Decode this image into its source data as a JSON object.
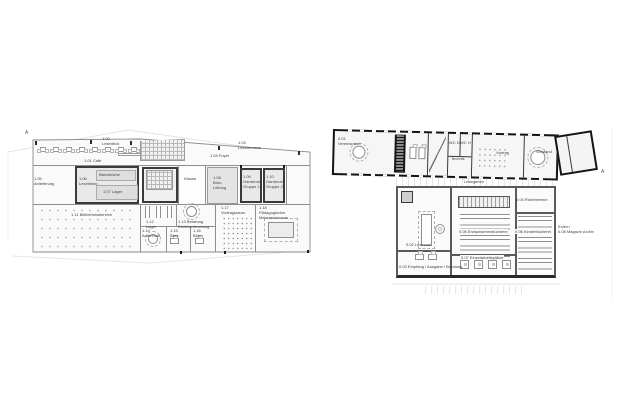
{
  "canvas": {
    "width": 625,
    "height": 400,
    "background": "#ffffff"
  },
  "drawing_type": "architectural floor plans, two levels side by side, grayscale",
  "colors": {
    "wall_dark": "#141414",
    "wall_mid": "#5a5a5a",
    "wall_light": "#8f8f8f",
    "room_gray": "#e4e4e4",
    "fill_light": "#f7f7f7",
    "label_text": "#3f3f3f",
    "site_line": "#e2e2e2"
  },
  "plans": {
    "left": {
      "name": "upper-floor-plan",
      "labels": [
        {
          "text": "A",
          "x": 25,
          "y": 130,
          "marker": true
        },
        {
          "text": "1.01 Café",
          "x": 84,
          "y": 158
        },
        {
          "text": "1.02\nLesedeck",
          "x": 102,
          "y": 136
        },
        {
          "text": "1.03\nLeseterrasse",
          "x": 238,
          "y": 140
        },
        {
          "text": "1.04 Foyer",
          "x": 210,
          "y": 153
        },
        {
          "text": "1.05\nAnlieferung",
          "x": 34,
          "y": 176
        },
        {
          "text": "1.06\nLesebistro",
          "x": 79,
          "y": 176
        },
        {
          "text": "Bistroküche",
          "x": 99,
          "y": 172
        },
        {
          "text": "1.07 Lager",
          "x": 103,
          "y": 189
        },
        {
          "text": "Klause",
          "x": 184,
          "y": 176
        },
        {
          "text": "1.08\nBüro\nLeitung",
          "x": 213,
          "y": 175
        },
        {
          "text": "1.09\nGarderobe\nGruppe 1",
          "x": 243,
          "y": 174
        },
        {
          "text": "1.10\nGarderobe\nGruppe 2",
          "x": 266,
          "y": 174
        },
        {
          "text": "1.11 Bibliotheksbereich",
          "x": 70,
          "y": 212,
          "bg": true
        },
        {
          "text": "1.12\nLager",
          "x": 146,
          "y": 219
        },
        {
          "text": "1.13 Beratung\nDirektverbuchung",
          "x": 178,
          "y": 219
        },
        {
          "text": "1.14\nAufenthalt",
          "x": 142,
          "y": 228
        },
        {
          "text": "1.15\nBüro",
          "x": 170,
          "y": 228
        },
        {
          "text": "1.16\nBüro",
          "x": 193,
          "y": 228
        },
        {
          "text": "1.17\nVortragsraum",
          "x": 221,
          "y": 205
        },
        {
          "text": "1.18\nPädagogischer\nMehrzweckraum",
          "x": 259,
          "y": 205
        }
      ]
    },
    "right": {
      "name": "ground-floor-plan",
      "labels": [
        {
          "text": "0.01\nVereinsraum",
          "x": 338,
          "y": 136
        },
        {
          "text": "WC D",
          "x": 449,
          "y": 140
        },
        {
          "text": "WC H",
          "x": 460,
          "y": 140
        },
        {
          "text": "Technik",
          "x": 451,
          "y": 156
        },
        {
          "text": "Vortrag",
          "x": 496,
          "y": 150
        },
        {
          "text": "Vorstand",
          "x": 536,
          "y": 149
        },
        {
          "text": "Lesegarten",
          "x": 464,
          "y": 179
        },
        {
          "text": "0.02 Lesesaal",
          "x": 406,
          "y": 242
        },
        {
          "text": "0.03 Empfang / Ausgabe / Beratung",
          "x": 399,
          "y": 264
        },
        {
          "text": "0.04 Ruhebereich",
          "x": 516,
          "y": 197
        },
        {
          "text": "0.05 Erwachsenenbücherei",
          "x": 458,
          "y": 229,
          "bg": true
        },
        {
          "text": "0.06 Kinderbücherei",
          "x": 514,
          "y": 229,
          "bg": true
        },
        {
          "text": "0.07 Einzelarbeitsplätze",
          "x": 460,
          "y": 255,
          "bg": true
        },
        {
          "text": "Extern\n0.08 Magazin Archiv",
          "x": 558,
          "y": 224
        },
        {
          "text": "A",
          "x": 601,
          "y": 169,
          "marker": true
        }
      ]
    }
  }
}
